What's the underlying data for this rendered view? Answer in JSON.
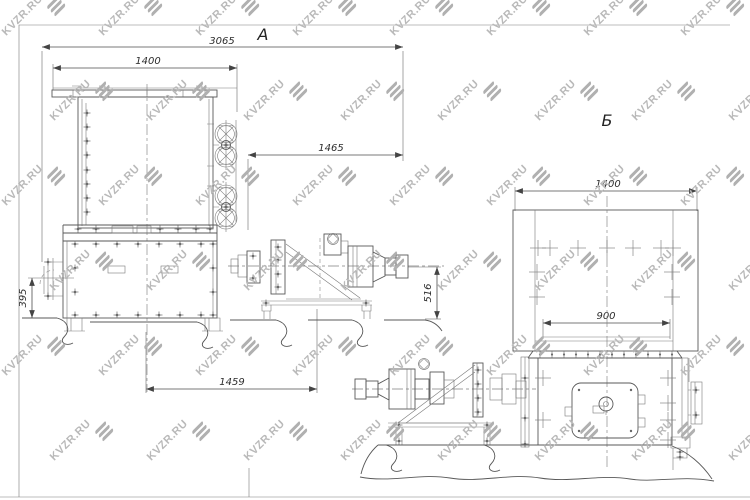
{
  "sheet": {
    "background": "#ffffff",
    "line_color": "#585858"
  },
  "watermark": {
    "text": "KVZR.RU",
    "text_color": "#b9b9b9",
    "icon_color": "#b0b0b0",
    "icon": "three-diagonal-bars"
  },
  "views": {
    "a": {
      "label": "А",
      "dims": {
        "overall_length": "3065",
        "frame_width": "1400",
        "shaft_span": "1465",
        "housing_height": "395",
        "shaft_axis_height": "516",
        "base_span": "1459"
      }
    },
    "b": {
      "label": "Б",
      "dims": {
        "frame_width": "1400",
        "mount_span": "900"
      }
    }
  }
}
